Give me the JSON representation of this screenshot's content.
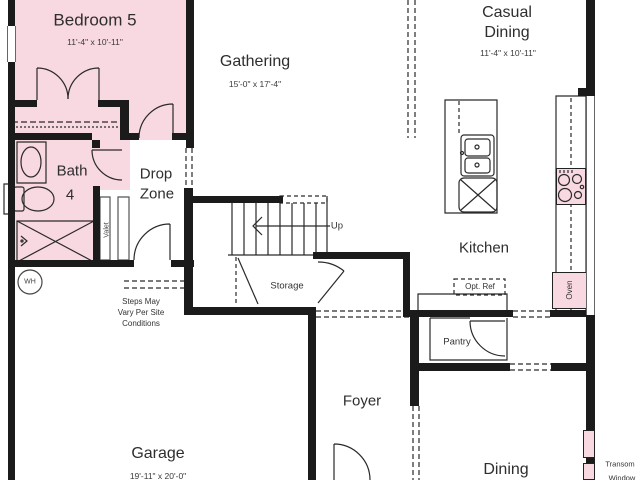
{
  "rooms": {
    "bedroom5": {
      "label": "Bedroom 5",
      "dims": "11'-4\" x 10'-11\""
    },
    "gathering": {
      "label": "Gathering",
      "dims": "15'-0\" x 17'-4\""
    },
    "casual_dining": {
      "label_line1": "Casual",
      "label_line2": "Dining",
      "dims": "11'-4\" x 10'-11\""
    },
    "bath4": {
      "label_line1": "Bath",
      "label_line2": "4"
    },
    "drop_zone": {
      "label_line1": "Drop",
      "label_line2": "Zone"
    },
    "kitchen": {
      "label": "Kitchen"
    },
    "pantry": {
      "label": "Pantry"
    },
    "storage": {
      "label": "Storage"
    },
    "foyer": {
      "label": "Foyer"
    },
    "garage": {
      "label": "Garage",
      "dims": "19'-11\" x 20'-0\""
    },
    "dining": {
      "label": "Dining"
    }
  },
  "annotations": {
    "up": "Up",
    "opt_ref": "Opt. Ref",
    "oven": "Oven",
    "valet": "Valet",
    "water_heater": "WH",
    "transom_line1": "Transom",
    "transom_line2": "Window",
    "steps_note_line1": "Steps May",
    "steps_note_line2": "Vary Per Site",
    "steps_note_line3": "Conditions"
  },
  "colors": {
    "room_pink": "#f8d8e1",
    "wall_black": "#1b1b1b"
  }
}
